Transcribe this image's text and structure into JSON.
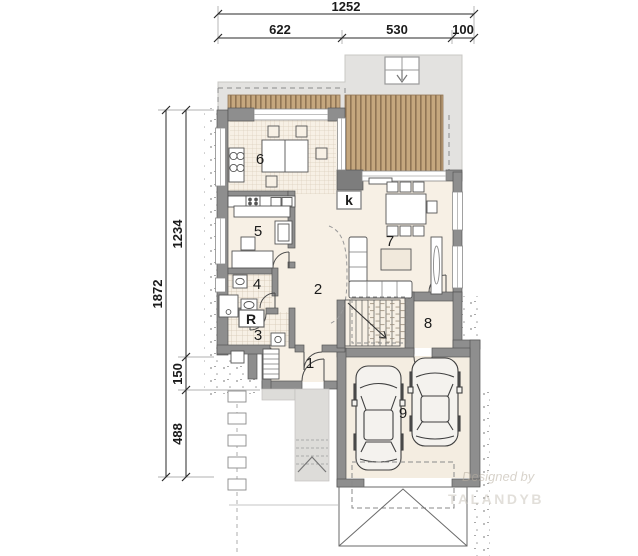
{
  "dimensions": {
    "top": {
      "total": "1252",
      "left": "622",
      "middle": "530",
      "right": "100"
    },
    "left": {
      "total": "1872",
      "upper": "1234",
      "middle": "150",
      "lower": "488"
    }
  },
  "rooms": {
    "r1": "1",
    "r2": "2",
    "r3": "3",
    "r4": "4",
    "r5": "5",
    "r6": "6",
    "r7": "7",
    "r8": "8",
    "r9": "9"
  },
  "labels": {
    "fireplace": "k",
    "boiler": "R"
  },
  "watermark": {
    "line1": "Designed by",
    "line2": "TALANDYB"
  }
}
